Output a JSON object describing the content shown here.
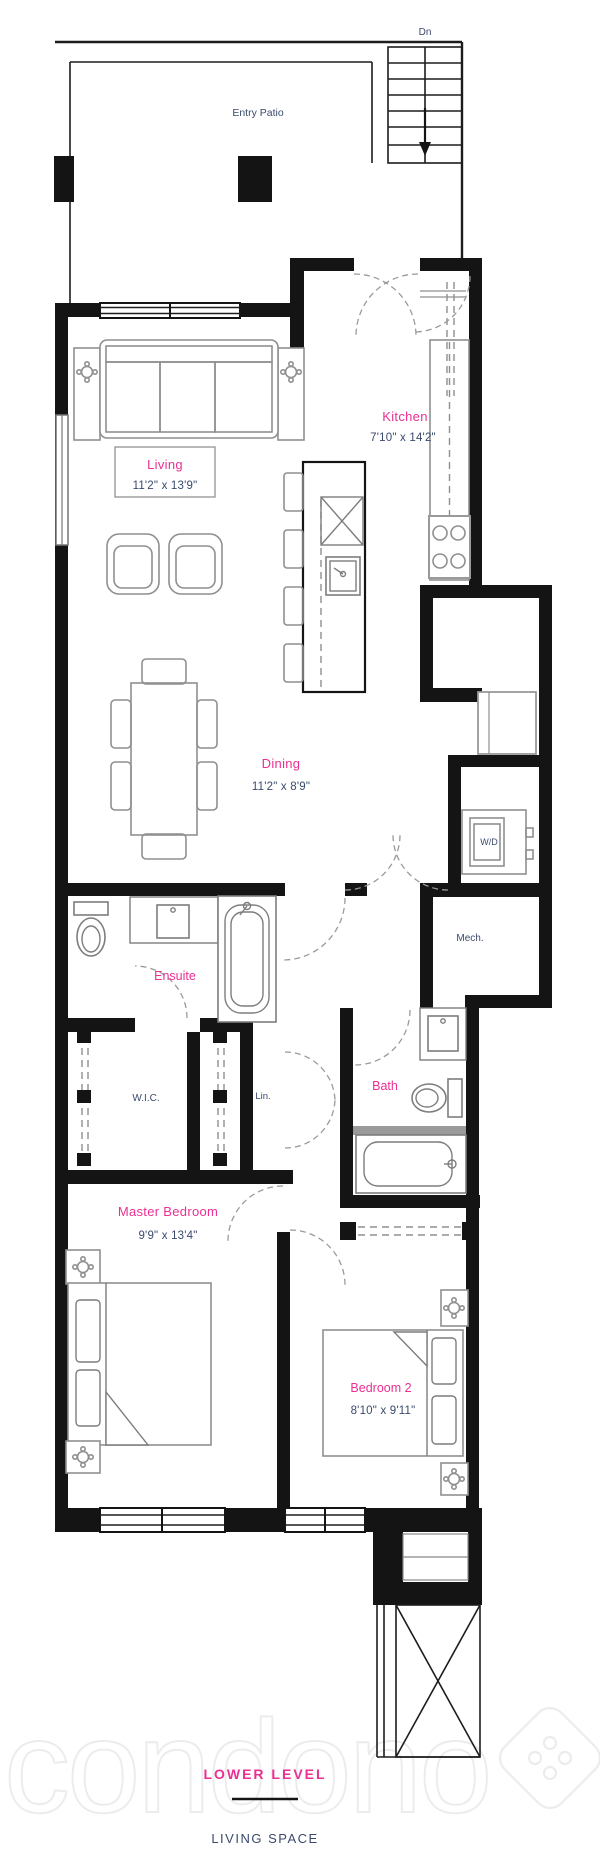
{
  "title": {
    "level": "LOWER LEVEL",
    "space": "LIVING SPACE"
  },
  "labels": {
    "stairs": "Dn",
    "patio": "Entry Patio",
    "kitchen": {
      "name": "Kitchen",
      "dims": "7'10\" x 14'2\""
    },
    "living": {
      "name": "Living",
      "dims": "11'2\" x 13'9\""
    },
    "dining": {
      "name": "Dining",
      "dims": "11'2\" x 8'9\""
    },
    "wd": "W/D",
    "mech": "Mech.",
    "ensuite": "Ensuite",
    "wic": "W.I.C.",
    "linen": "Lin.",
    "bath": "Bath",
    "master": {
      "name": "Master Bedroom",
      "dims": "9'9\" x 13'4\""
    },
    "bedroom2": {
      "name": "Bedroom 2",
      "dims": "8'10\" x 9'11\""
    }
  },
  "watermark": "condono",
  "colors": {
    "room_name": "#ec2f92",
    "dimension": "#3a4a6d",
    "wall": "#141414",
    "furniture": "#8f8f8f"
  }
}
